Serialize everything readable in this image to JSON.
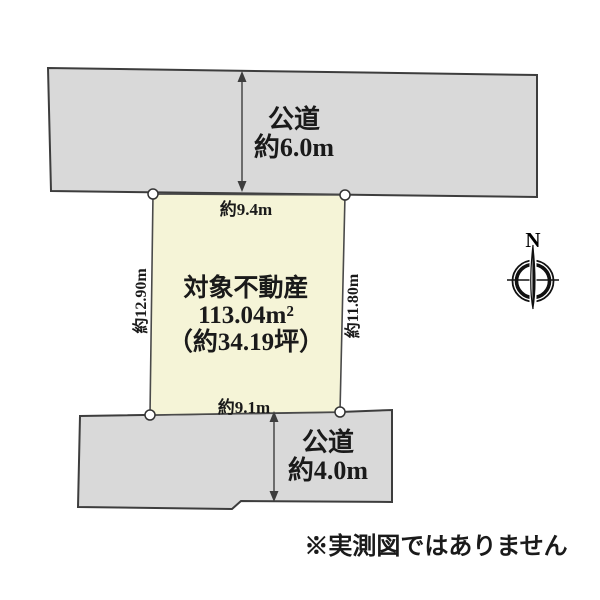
{
  "colors": {
    "background": "#ffffff",
    "road_fill": "#d9d9d9",
    "plot_fill": "#f5f4d7",
    "line": "#3d3d3d",
    "text": "#1a1a1a"
  },
  "top_road": {
    "name": "公道",
    "width_label": "約6.0m"
  },
  "bottom_road": {
    "name": "公道",
    "width_label": "約4.0m"
  },
  "plot": {
    "title": "対象不動産",
    "area_m2": "113.04m²",
    "area_tsubo": "（約34.19坪）",
    "top_edge_label": "約9.4m",
    "bottom_edge_label": "約9.1m",
    "left_edge_label": "約12.90m",
    "right_edge_label": "約11.80m"
  },
  "compass": {
    "label": "N"
  },
  "footer": {
    "note": "※実測図ではありません"
  }
}
